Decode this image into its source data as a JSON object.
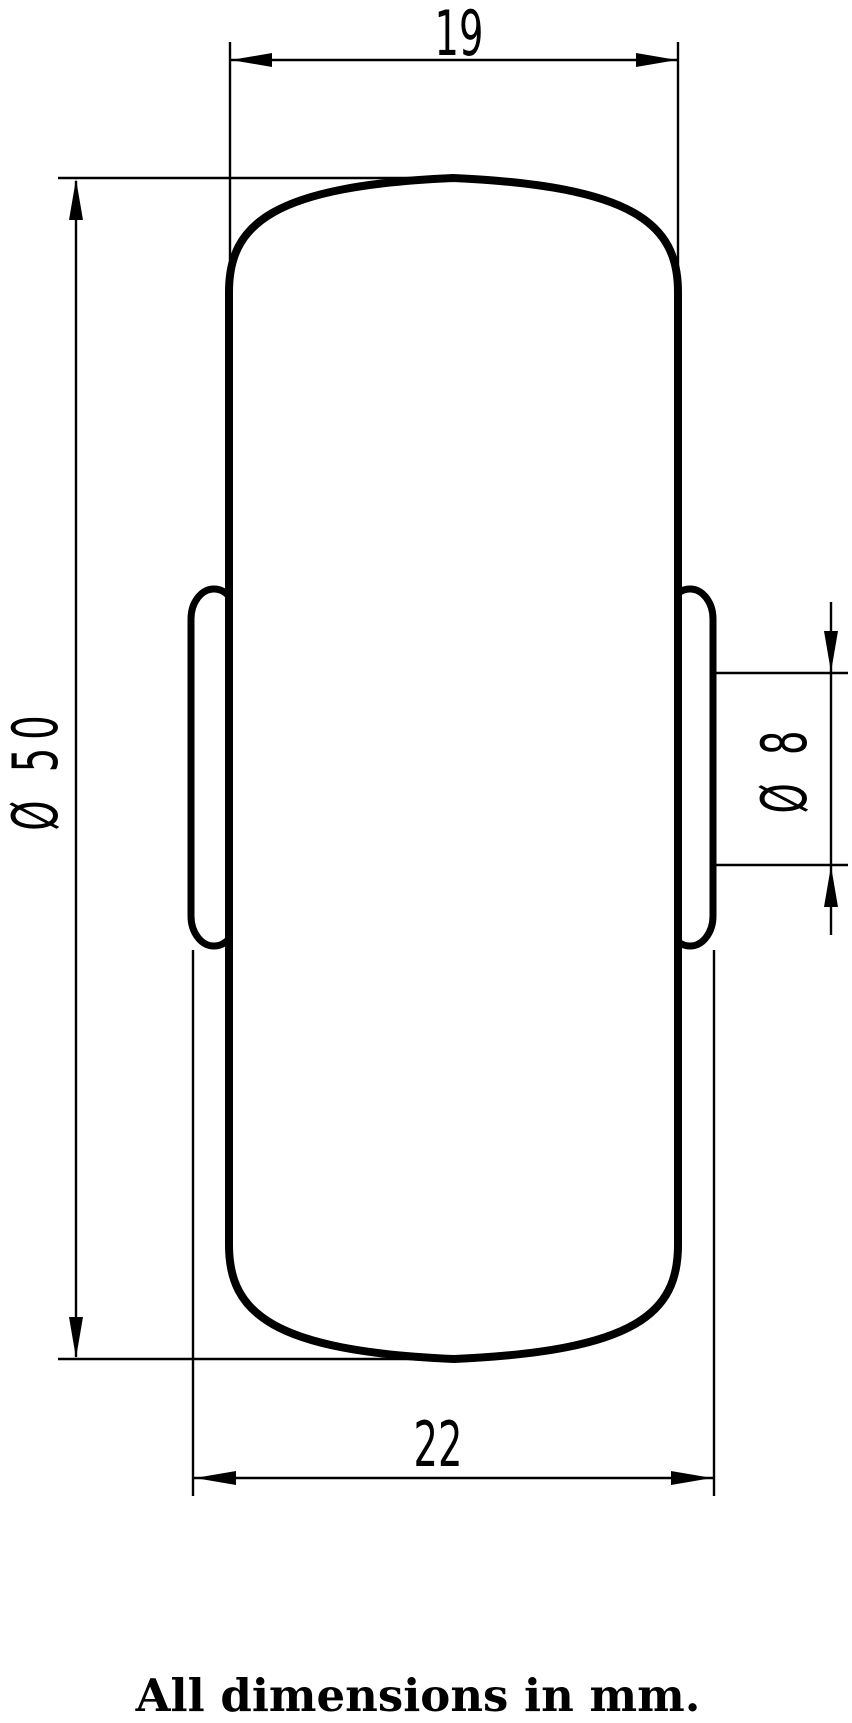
{
  "drawing": {
    "dimensions": {
      "top_width": {
        "label": "19",
        "value": 19,
        "unit": "mm"
      },
      "overall_width": {
        "label": "22",
        "value": 22,
        "unit": "mm"
      },
      "outer_diameter": {
        "label": "Ø 50",
        "value": 50,
        "unit": "mm"
      },
      "bore_diameter": {
        "label": "Ø 8",
        "value": 8,
        "unit": "mm"
      }
    },
    "note": "All dimensions in mm.",
    "colors": {
      "ink": "#000000",
      "background": "#ffffff"
    }
  }
}
